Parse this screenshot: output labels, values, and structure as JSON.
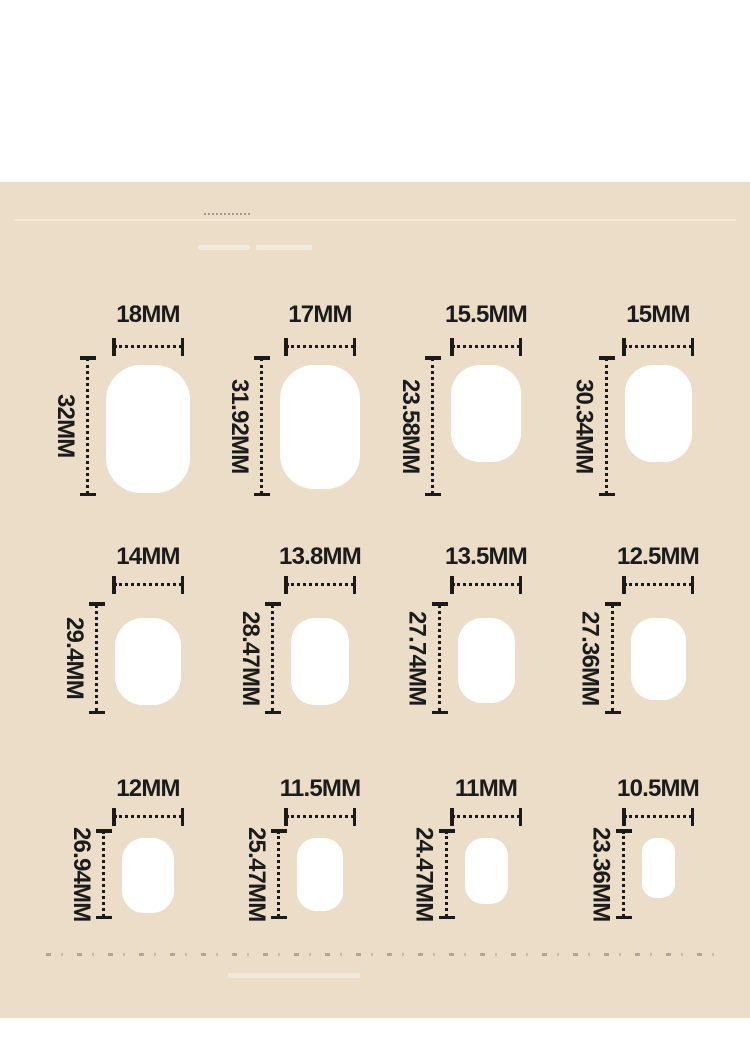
{
  "colors": {
    "background": "#ebddc8",
    "nail_shape": "#ffffff",
    "ink": "#1b1b1b"
  },
  "size_chart": {
    "unit": "MM",
    "rows": [
      {
        "cells": [
          {
            "width_label": "18MM",
            "length_label": "32MM"
          },
          {
            "width_label": "17MM",
            "length_label": "31.92MM"
          },
          {
            "width_label": "15.5MM",
            "length_label": "23.58MM"
          },
          {
            "width_label": "15MM",
            "length_label": "30.34MM"
          }
        ]
      },
      {
        "cells": [
          {
            "width_label": "14MM",
            "length_label": "29.4MM"
          },
          {
            "width_label": "13.8MM",
            "length_label": "28.47MM"
          },
          {
            "width_label": "13.5MM",
            "length_label": "27.74MM"
          },
          {
            "width_label": "12.5MM",
            "length_label": "27.36MM"
          }
        ]
      },
      {
        "cells": [
          {
            "width_label": "12MM",
            "length_label": "26.94MM"
          },
          {
            "width_label": "11.5MM",
            "length_label": "25.47MM"
          },
          {
            "width_label": "11MM",
            "length_label": "24.47MM"
          },
          {
            "width_label": "10.5MM",
            "length_label": "23.36MM"
          }
        ]
      }
    ]
  }
}
